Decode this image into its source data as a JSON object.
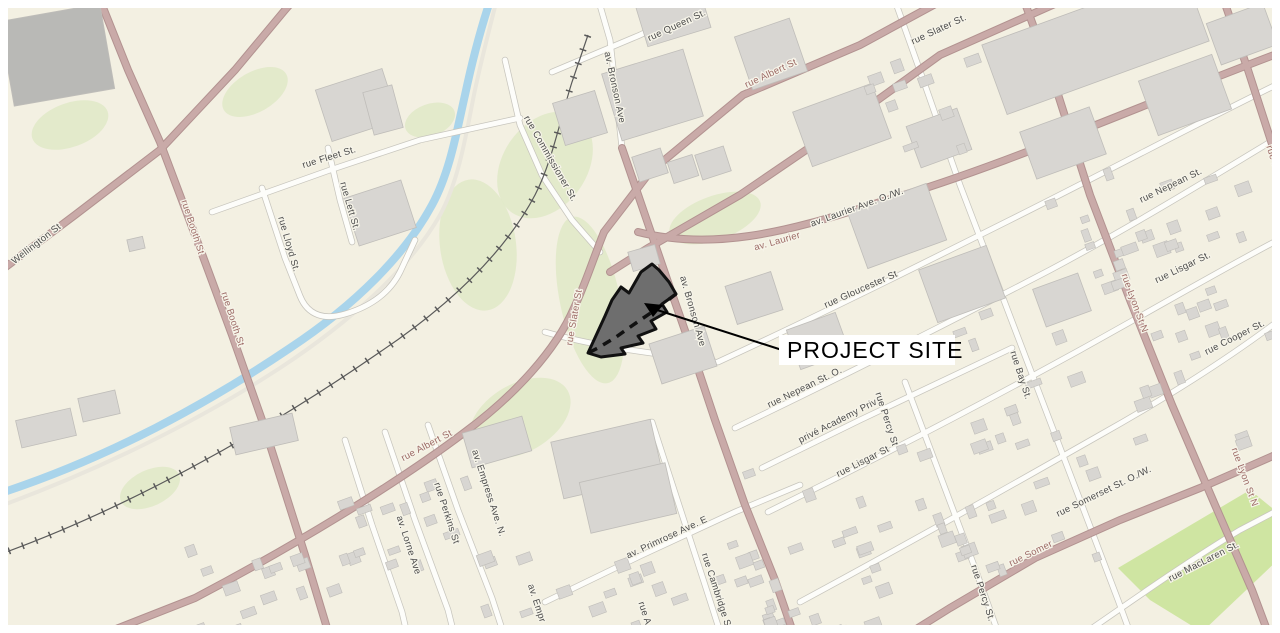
{
  "page": {
    "title": "PROJECT SITE"
  },
  "map": {
    "width": 1280,
    "height": 633,
    "margin": 8,
    "bg": "#f3f0e2",
    "colors": {
      "road_major_fill": "#c9aaa8",
      "road_major_casing": "#b29290",
      "road_minor_fill": "#fdfdfa",
      "road_minor_casing": "#c7c5bd",
      "road_path": "#e9e6dc",
      "water": "#a9d4eb",
      "green": "#dfe9c6",
      "park": "#cfe5a2",
      "building": "#d8d6d2",
      "building_stroke": "#bfbdb9",
      "building_dark": "#b9b9b6",
      "rail": "#5a5a5a",
      "label_gray": "#4c4c4c",
      "label_red": "#9c6a66",
      "site_fill": "#6e6e6e",
      "site_stroke": "#111111"
    }
  },
  "roads": {
    "major": [
      {
        "name": "wellington-st",
        "d": "M -5 275 L 75 215 L 160 150 L 235 70 L 285 10 L 298 -5"
      },
      {
        "name": "booth-st",
        "d": "M 98 -5 L 128 70 L 160 142 L 195 235 L 232 335 L 262 420 L 285 492 L 305 555 L 330 638"
      },
      {
        "name": "albert-st-east",
        "d": "M 952 -5 L 860 45 L 743 95 L 650 172 L 604 232"
      },
      {
        "name": "slater-st-east",
        "d": "M 1075 -5 L 940 55 L 850 120 L 740 195 L 648 248 L 610 272"
      },
      {
        "name": "albert-slater-curve",
        "d": "M 604 232 C 592 262 585 285 574 308 C 556 350 515 395 465 432 C 395 485 290 548 195 598 L 88 640"
      },
      {
        "name": "laurier-ave",
        "d": "M 638 232 C 710 250 780 235 880 202 C 1000 168 1140 105 1282 52"
      },
      {
        "name": "bronson-ave",
        "d": "M 622 148 L 645 215 L 668 282 L 690 345 L 715 420 L 745 505 L 775 580 L 795 638"
      },
      {
        "name": "lyon-st",
        "d": "M 1022 -5 L 1055 85 L 1090 195 L 1130 300 L 1172 405 L 1215 505 L 1252 590 L 1270 638"
      },
      {
        "name": "kent-st",
        "d": "M 1222 -5 L 1248 70 L 1282 175"
      },
      {
        "name": "somerset-st",
        "d": "M 902 638 L 950 608 L 1035 558 L 1120 520 L 1200 488 L 1282 452"
      }
    ],
    "minor": [
      {
        "name": "queen-st",
        "d": "M 552 72 L 640 35 L 722 -5"
      },
      {
        "name": "fleet-st",
        "d": "M 212 212 L 330 170 L 420 140 L 520 118"
      },
      {
        "name": "lett-st",
        "d": "M 328 148 L 340 200 L 352 242"
      },
      {
        "name": "lloyd-st",
        "d": "M 262 188 L 285 258 L 300 296 C 308 316 325 320 345 314 C 372 306 390 292 400 272 L 415 240"
      },
      {
        "name": "commissioner-st",
        "d": "M 505 60 L 520 125 L 542 175 L 572 220 L 600 252"
      },
      {
        "name": "bronson-north",
        "d": "M 597 -5 L 610 40 L 622 148"
      },
      {
        "name": "gloucester-st",
        "d": "M 718 362 C 820 315 920 265 1010 220 C 1110 170 1200 122 1282 82"
      },
      {
        "name": "nepean-st",
        "d": "M 735 428 C 840 378 950 322 1050 270 C 1140 222 1220 172 1282 135"
      },
      {
        "name": "lisgar-st",
        "d": "M 768 512 C 870 462 980 405 1080 350 C 1170 300 1235 262 1282 238"
      },
      {
        "name": "cooper-st",
        "d": "M 800 602 C 900 548 1000 492 1100 435 C 1180 390 1240 350 1282 318"
      },
      {
        "name": "maclaren-st",
        "d": "M 1078 638 C 1140 595 1190 560 1240 530 L 1282 508"
      },
      {
        "name": "academy-priv",
        "d": "M 762 468 L 860 420 L 1012 348"
      },
      {
        "name": "primrose-ave",
        "d": "M 545 602 L 640 556 L 735 512 L 800 485"
      },
      {
        "name": "bay-st",
        "d": "M 893 -5 L 925 85 L 960 185 L 1000 290 L 1040 395 L 1080 500 L 1118 600 L 1132 638"
      },
      {
        "name": "percy-st",
        "d": "M 905 382 L 940 475 L 975 568 L 1000 638"
      },
      {
        "name": "cambridge-st",
        "d": "M 652 422 L 678 502 L 705 585 L 722 638"
      },
      {
        "name": "empress-ave",
        "d": "M 428 425 L 458 510 L 492 598 L 505 638"
      },
      {
        "name": "perkins-st",
        "d": "M 385 432 L 415 520 L 448 610 L 455 638"
      },
      {
        "name": "lorne-ave",
        "d": "M 345 440 L 372 525 L 402 612 L 408 638"
      },
      {
        "name": "site-south-connector",
        "d": "M 545 332 C 590 345 640 352 690 358 L 715 362"
      }
    ],
    "paths": [
      {
        "name": "aqueduct-path",
        "d": "M -5 508 C 100 470 200 420 280 368 C 350 322 410 268 440 215 C 458 182 465 140 472 105 C 478 72 488 35 498 -5"
      }
    ]
  },
  "railway": {
    "d": "M -5 556 C 120 512 260 435 380 352 C 450 305 505 252 535 195 C 552 162 560 120 572 82 L 588 35"
  },
  "water": {
    "d": "M -5 495 C 110 458 210 402 290 348 C 355 305 405 255 432 205 C 450 172 457 130 465 95 C 472 62 480 30 492 -5"
  },
  "areas": {
    "park": {
      "name": "park",
      "points": "1118,568 1250,490 1282,516 1282,556 1202,632 1150,600"
    },
    "greens": [
      {
        "cx": 545,
        "cy": 165,
        "rx": 58,
        "ry": 42,
        "rot": -55
      },
      {
        "cx": 590,
        "cy": 300,
        "rx": 30,
        "ry": 85,
        "rot": -12
      },
      {
        "cx": 520,
        "cy": 418,
        "rx": 55,
        "ry": 34,
        "rot": -30
      },
      {
        "cx": 478,
        "cy": 245,
        "rx": 38,
        "ry": 66,
        "rot": -8
      },
      {
        "cx": 715,
        "cy": 218,
        "rx": 48,
        "ry": 22,
        "rot": -20
      },
      {
        "cx": 255,
        "cy": 92,
        "rx": 36,
        "ry": 20,
        "rot": -30
      },
      {
        "cx": 70,
        "cy": 125,
        "rx": 40,
        "ry": 22,
        "rot": -20
      },
      {
        "cx": 150,
        "cy": 488,
        "rx": 32,
        "ry": 18,
        "rot": -25
      },
      {
        "cx": 430,
        "cy": 120,
        "rx": 26,
        "ry": 16,
        "rot": -20
      }
    ]
  },
  "buildings": [
    [
      6,
      12,
      102,
      86,
      -10,
      1
    ],
    [
      322,
      78,
      70,
      54,
      -18,
      0
    ],
    [
      368,
      88,
      30,
      44,
      -15,
      0
    ],
    [
      350,
      188,
      60,
      50,
      -18,
      0
    ],
    [
      558,
      96,
      44,
      44,
      -17,
      0
    ],
    [
      610,
      60,
      85,
      70,
      -17,
      0
    ],
    [
      640,
      -6,
      66,
      44,
      -17,
      0
    ],
    [
      742,
      26,
      58,
      56,
      -19,
      0
    ],
    [
      800,
      96,
      84,
      58,
      -20,
      0
    ],
    [
      988,
      6,
      215,
      74,
      -20,
      0
    ],
    [
      1212,
      12,
      60,
      44,
      -20,
      0
    ],
    [
      912,
      116,
      54,
      44,
      -20,
      0
    ],
    [
      1026,
      118,
      74,
      50,
      -20,
      0
    ],
    [
      1146,
      66,
      78,
      58,
      -20,
      0
    ],
    [
      855,
      196,
      84,
      60,
      -20,
      0
    ],
    [
      926,
      256,
      72,
      56,
      -20,
      0
    ],
    [
      1038,
      280,
      48,
      40,
      -20,
      0
    ],
    [
      730,
      278,
      48,
      40,
      -18,
      0
    ],
    [
      654,
      334,
      58,
      42,
      -18,
      0
    ],
    [
      792,
      320,
      52,
      42,
      -20,
      0
    ],
    [
      630,
      248,
      28,
      20,
      -16,
      0
    ],
    [
      635,
      152,
      30,
      26,
      -18,
      0
    ],
    [
      670,
      158,
      26,
      22,
      -18,
      0
    ],
    [
      698,
      150,
      30,
      26,
      -18,
      0
    ],
    [
      556,
      430,
      102,
      58,
      -13,
      0
    ],
    [
      584,
      472,
      88,
      52,
      -13,
      0
    ],
    [
      466,
      424,
      62,
      36,
      -16,
      0
    ],
    [
      18,
      414,
      56,
      28,
      -13,
      0
    ],
    [
      80,
      394,
      38,
      24,
      -13,
      0
    ],
    [
      232,
      420,
      64,
      28,
      -13,
      0
    ],
    [
      128,
      238,
      16,
      12,
      -13,
      0
    ]
  ],
  "clusters": [
    {
      "x": 995,
      "y": 165,
      "w": 285,
      "h": 125,
      "n": 26,
      "seed": 11
    },
    {
      "x": 950,
      "y": 300,
      "w": 320,
      "h": 145,
      "n": 30,
      "seed": 23
    },
    {
      "x": 895,
      "y": 440,
      "w": 200,
      "h": 125,
      "n": 22,
      "seed": 37
    },
    {
      "x": 700,
      "y": 470,
      "w": 185,
      "h": 150,
      "n": 20,
      "seed": 41
    },
    {
      "x": 755,
      "y": 565,
      "w": 150,
      "h": 65,
      "n": 12,
      "seed": 53
    },
    {
      "x": 475,
      "y": 540,
      "w": 210,
      "h": 90,
      "n": 16,
      "seed": 61
    },
    {
      "x": 175,
      "y": 545,
      "w": 160,
      "h": 88,
      "n": 14,
      "seed": 71
    },
    {
      "x": 330,
      "y": 452,
      "w": 135,
      "h": 110,
      "n": 16,
      "seed": 83
    },
    {
      "x": 845,
      "y": 55,
      "w": 130,
      "h": 95,
      "n": 10,
      "seed": 97
    }
  ],
  "labels": [
    {
      "text": "rue Queen St.",
      "x": 678,
      "y": 28,
      "rot": -25,
      "cls": "gray"
    },
    {
      "text": "rue Fleet St.",
      "x": 330,
      "y": 160,
      "rot": -17,
      "cls": "gray"
    },
    {
      "text": "rue Lett St.",
      "x": 347,
      "y": 207,
      "rot": 74,
      "cls": "gray"
    },
    {
      "text": "rue Lloyd St.",
      "x": 286,
      "y": 245,
      "rot": 74,
      "cls": "gray"
    },
    {
      "text": "rue Commissioner St.",
      "x": 548,
      "y": 160,
      "rot": 60,
      "cls": "gray"
    },
    {
      "text": "Wellington St",
      "x": 38,
      "y": 246,
      "rot": -38,
      "cls": "gray"
    },
    {
      "text": "rue Booth St",
      "x": 190,
      "y": 228,
      "rot": 72,
      "cls": "red"
    },
    {
      "text": "rue Booth St",
      "x": 230,
      "y": 320,
      "rot": 72,
      "cls": "red"
    },
    {
      "text": "rue Albert St",
      "x": 772,
      "y": 76,
      "rot": -25,
      "cls": "red"
    },
    {
      "text": "rue Slater St.",
      "x": 940,
      "y": 32,
      "rot": -25,
      "cls": "gray"
    },
    {
      "text": "rue Slater St",
      "x": 577,
      "y": 318,
      "rot": -80,
      "cls": "red"
    },
    {
      "text": "rue Albert St",
      "x": 428,
      "y": 448,
      "rot": -28,
      "cls": "red"
    },
    {
      "text": "av. Laurier",
      "x": 778,
      "y": 244,
      "rot": -16,
      "cls": "red"
    },
    {
      "text": "av. Laurier Ave. O./W.",
      "x": 858,
      "y": 210,
      "rot": -20,
      "cls": "gray"
    },
    {
      "text": "av. Bronson Ave",
      "x": 612,
      "y": 88,
      "rot": 78,
      "cls": "gray"
    },
    {
      "text": "av. Bronson Ave",
      "x": 690,
      "y": 312,
      "rot": 74,
      "cls": "gray"
    },
    {
      "text": "rue Gloucester St",
      "x": 862,
      "y": 292,
      "rot": -24,
      "cls": "gray"
    },
    {
      "text": "rue Nepean St. O.",
      "x": 806,
      "y": 390,
      "rot": -26,
      "cls": "gray"
    },
    {
      "text": "rue Nepean St.",
      "x": 1172,
      "y": 188,
      "rot": -26,
      "cls": "gray"
    },
    {
      "text": "privé Academy Priv.",
      "x": 840,
      "y": 423,
      "rot": -27,
      "cls": "gray"
    },
    {
      "text": "rue Lisgar St",
      "x": 864,
      "y": 464,
      "rot": -27,
      "cls": "gray"
    },
    {
      "text": "rue Lisgar St.",
      "x": 1184,
      "y": 270,
      "rot": -26,
      "cls": "gray"
    },
    {
      "text": "rue Cooper St.",
      "x": 1236,
      "y": 340,
      "rot": -27,
      "cls": "gray"
    },
    {
      "text": "rue Bay St.",
      "x": 1018,
      "y": 376,
      "rot": 72,
      "cls": "gray"
    },
    {
      "text": "rue Percy St",
      "x": 884,
      "y": 420,
      "rot": 72,
      "cls": "gray"
    },
    {
      "text": "rue Percy St.",
      "x": 980,
      "y": 594,
      "rot": 72,
      "cls": "gray"
    },
    {
      "text": "rue Lyon St N",
      "x": 1132,
      "y": 304,
      "rot": 70,
      "cls": "red"
    },
    {
      "text": "rue Lyon St N",
      "x": 1242,
      "y": 478,
      "rot": 70,
      "cls": "red"
    },
    {
      "text": "rue K",
      "x": 1270,
      "y": 158,
      "rot": 72,
      "cls": "red"
    },
    {
      "text": "rue Somer",
      "x": 1032,
      "y": 556,
      "rot": -26,
      "cls": "red"
    },
    {
      "text": "rue Somerset St. O./W.",
      "x": 1105,
      "y": 494,
      "rot": -26,
      "cls": "gray"
    },
    {
      "text": "rue MacLaren St.",
      "x": 1205,
      "y": 564,
      "rot": -27,
      "cls": "gray"
    },
    {
      "text": "av. Primrose Ave. E",
      "x": 668,
      "y": 540,
      "rot": -25,
      "cls": "gray"
    },
    {
      "text": "av. Empress Ave. N.",
      "x": 486,
      "y": 494,
      "rot": 72,
      "cls": "gray"
    },
    {
      "text": "av. Empr",
      "x": 534,
      "y": 604,
      "rot": 72,
      "cls": "gray"
    },
    {
      "text": "rue Perkins St",
      "x": 444,
      "y": 514,
      "rot": 72,
      "cls": "gray"
    },
    {
      "text": "av. Lorne Ave",
      "x": 406,
      "y": 546,
      "rot": 72,
      "cls": "gray"
    },
    {
      "text": "rue Cambridge St",
      "x": 714,
      "y": 592,
      "rot": 72,
      "cls": "gray"
    },
    {
      "text": "rue A",
      "x": 642,
      "y": 614,
      "rot": 72,
      "cls": "gray"
    }
  ],
  "site": {
    "polygon": "588,353 605,316 612,300 621,287 629,293 641,272 652,264 659,270 669,282 676,294 662,304 667,312 651,321 656,329 638,336 643,343 621,348 625,354 601,357",
    "dashed_edge": "M 676 294 L 655 310 L 636 323 L 616 337 L 598 348 L 588 353",
    "leader": {
      "x1": 782,
      "y1": 350,
      "x2": 654,
      "y2": 309,
      "arrowhead": "644,303 663,305 653,317"
    },
    "label": {
      "text": "PROJECT SITE",
      "box_x": 779,
      "box_y": 335,
      "box_w": 176,
      "box_h": 30,
      "text_x": 787,
      "text_y": 358,
      "font_size": 23
    }
  }
}
